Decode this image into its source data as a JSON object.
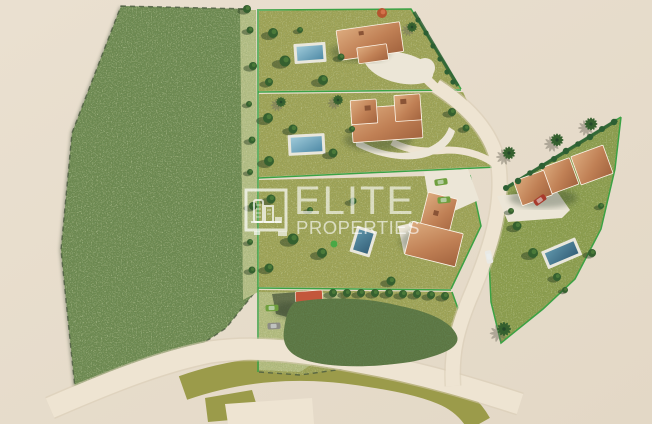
{
  "watermark": {
    "brand": "ELITE",
    "brand_sub": "PROPERTIES"
  },
  "scene": {
    "type": "aerial-3d-site-plan",
    "villas": 4,
    "pools": 4,
    "outbuildings": 1,
    "cars": 6,
    "parcels": 6
  },
  "colors": {
    "bg1": "#eae0d0",
    "bg2": "#e2d7c5",
    "field": "#6e8950",
    "fieldEdge": "#45523b",
    "strip": "#b6bf86",
    "grass": "#a0a356",
    "grass2": "#8d9d4d",
    "grassLight": "#b6bd80",
    "lineGreen": "#3ba244",
    "hedge": "#2d5f33",
    "dashLine": "#4a5a3e",
    "road": "#eee4d2",
    "roadEdge": "#d8ccb5",
    "olive": "#9b9b4a",
    "roofLight": "#d9a87c",
    "roof": "#c08055",
    "roofDark": "#a2633e",
    "terrace": "#ece6d7",
    "poolDeck": "#e9e7dc",
    "water1": "#8fc0d2",
    "water2": "#4f8aa6",
    "waterDark": "#39697f",
    "shedRoof": "#c3573b",
    "tree": "#35602f",
    "treeInner": "#4e7d3b",
    "shrub": "#5c7542",
    "carGreen": "#6f9f3e",
    "carGrey": "#8d8d85",
    "carRed": "#a83a2c",
    "carWhite": "#e9e9e4",
    "watermark": "rgba(255,255,255,0.62)"
  }
}
